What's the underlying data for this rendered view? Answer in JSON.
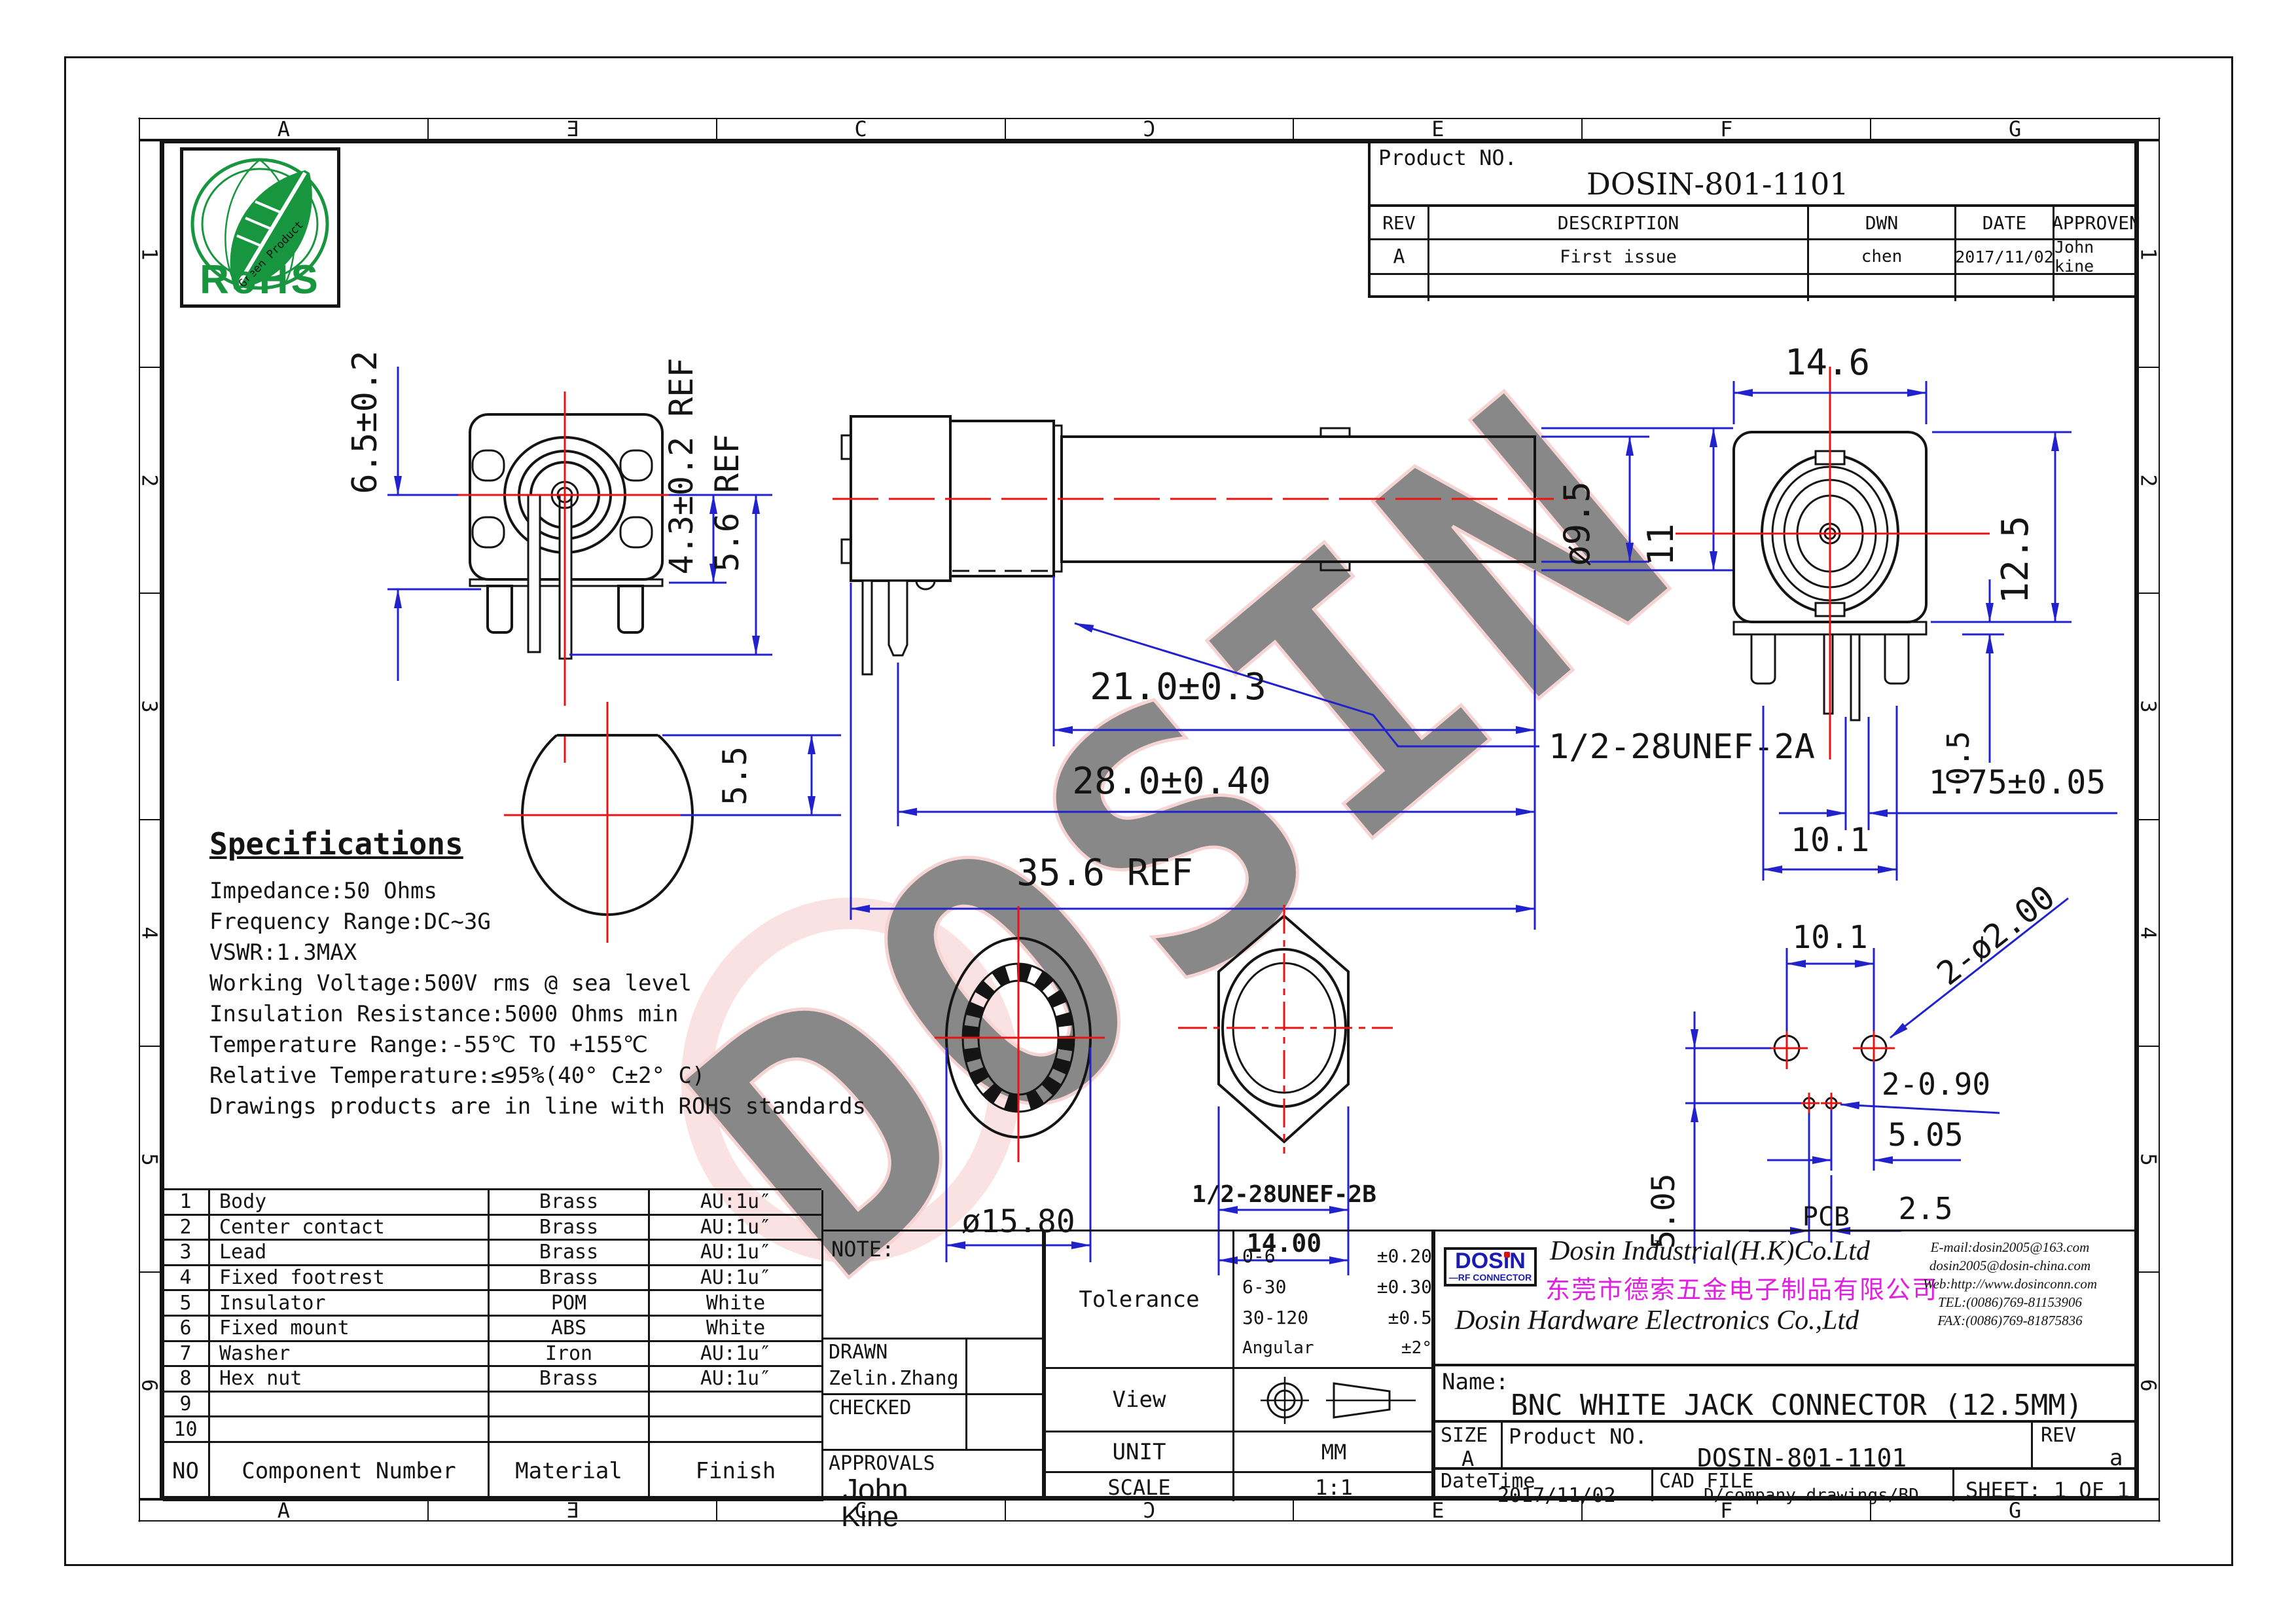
{
  "frame": {
    "letters": [
      "A",
      "Ǝ",
      "C",
      "Ɔ",
      "E",
      "F",
      "G"
    ],
    "rows": [
      "1",
      "2",
      "3",
      "4",
      "5",
      "6"
    ]
  },
  "watermark": {
    "text": "DOSIN",
    "color": "#f6c6c6"
  },
  "colors": {
    "dim": "#2222cc",
    "center": "#e81414",
    "magenta": "#e020e0",
    "dosin_blue": "#1b1bb4",
    "green": "#17953f"
  },
  "rohs": {
    "title": "RoHS",
    "subtitle": "Green Product"
  },
  "rev_table": {
    "product_label": "Product NO.",
    "product_no": "DOSIN-801-1101",
    "headers": {
      "rev": "REV",
      "description": "DESCRIPTION",
      "dwn": "DWN",
      "date": "DATE",
      "approven": "APPROVEN"
    },
    "rows": [
      {
        "rev": "A",
        "description": "First issue",
        "dwn": "chen",
        "date": "2017/11/02",
        "approven": "John kine"
      }
    ]
  },
  "views": {
    "front": {
      "d_height": "6.5±0.2",
      "d_ref1": "4.3±0.2 REF",
      "d_ref2": "5.6 REF"
    },
    "cut": {
      "d": "5.5"
    },
    "side": {
      "d_len1": "21.0±0.3",
      "d_len2": "28.0±0.40",
      "d_len3": "35.6 REF",
      "d_dia": "ø9.5",
      "d_height": "11",
      "thread": "1/2-28UNEF-2A"
    },
    "back": {
      "d_width": "14.6",
      "d_height": "12.5",
      "d_base": "0.5",
      "d_pin": "1.75±0.05",
      "d_span": "10.1"
    },
    "washer": {
      "d_dia": "ø15.80"
    },
    "nut": {
      "thread": "1/2-28UNEF-2B",
      "d_flat": "14.00"
    },
    "pcb": {
      "label": "PCB",
      "d_span": "10.1",
      "d_holes": "2-ø2.00",
      "d_small": "2-0.90",
      "d_v": "5.05",
      "d_h": "5.05",
      "d_pitch": "2.5"
    }
  },
  "specs": {
    "title": "Specifications",
    "lines": [
      "Impedance:50 Ohms",
      "Frequency Range:DC~3G",
      "VSWR:1.3MAX",
      "Working Voltage:500V rms @ sea level",
      "Insulation Resistance:5000 Ohms min",
      "Temperature Range:-55℃ TO +155℃",
      "Relative Temperature:≤95%(40° C±2° C)",
      "Drawings products are in line with ROHS standards"
    ]
  },
  "parts": {
    "headers": {
      "no": "NO",
      "component": "Component Number",
      "material": "Material",
      "finish": "Finish"
    },
    "rows": [
      {
        "no": "1",
        "component": "Body",
        "material": "Brass",
        "finish": "AU:1u″"
      },
      {
        "no": "2",
        "component": "Center contact",
        "material": "Brass",
        "finish": "AU:1u″"
      },
      {
        "no": "3",
        "component": "Lead",
        "material": "Brass",
        "finish": "AU:1u″"
      },
      {
        "no": "4",
        "component": "Fixed footrest",
        "material": "Brass",
        "finish": "AU:1u″"
      },
      {
        "no": "5",
        "component": "Insulator",
        "material": "POM",
        "finish": "White"
      },
      {
        "no": "6",
        "component": "Fixed mount",
        "material": "ABS",
        "finish": "White"
      },
      {
        "no": "7",
        "component": "Washer",
        "material": "Iron",
        "finish": "AU:1u″"
      },
      {
        "no": "8",
        "component": "Hex nut",
        "material": "Brass",
        "finish": "AU:1u″"
      },
      {
        "no": "9",
        "component": "",
        "material": "",
        "finish": ""
      },
      {
        "no": "10",
        "component": "",
        "material": "",
        "finish": ""
      }
    ]
  },
  "note": {
    "label": "NOTE:",
    "drawn_label": "DRAWN",
    "drawn": "Zelin.Zhang",
    "checked_label": "CHECKED",
    "approvals_label": "APPROVALS",
    "approver_first": "John",
    "approver_last": "Kine"
  },
  "tolerance": {
    "label": "Tolerance",
    "rows": [
      {
        "range": "0-6",
        "value": "±0.20"
      },
      {
        "range": "6-30",
        "value": "±0.30"
      },
      {
        "range": "30-120",
        "value": "±0.5"
      },
      {
        "range": "Angular",
        "value": "±2°"
      }
    ]
  },
  "view_row": {
    "label": "View"
  },
  "unit_row": {
    "label": "UNIT",
    "value": "MM"
  },
  "scale_row": {
    "label": "SCALE",
    "value": "1:1"
  },
  "company": {
    "logo": "DOSiN",
    "logo_sub": "—RF CONNECTOR",
    "en1": "Dosin Industrial(H.K)Co.Ltd",
    "cn": "东莞市德索五金电子制品有限公司",
    "en2": "Dosin Hardware Electronics Co.,Ltd",
    "contacts": [
      "E-mail:dosin2005@163.com",
      "dosin2005@dosin-china.com",
      "Web:http://www.dosinconn.com",
      "TEL:(0086)769-81153906",
      "FAX:(0086)769-81875836"
    ]
  },
  "title_block": {
    "name_label": "Name:",
    "name": "BNC WHITE JACK CONNECTOR (12.5MM)",
    "size_label": "SIZE",
    "size": "A",
    "product_label": "Product NO.",
    "product_no": "DOSIN-801-1101",
    "rev_label": "REV",
    "rev": "a",
    "datetime_label": "DateTime",
    "datetime": "2017/11/02",
    "cadfile_label": "CAD FILE",
    "cadfile": "D/company drawings/BD",
    "sheet": "SHEET: 1 OF 1"
  }
}
